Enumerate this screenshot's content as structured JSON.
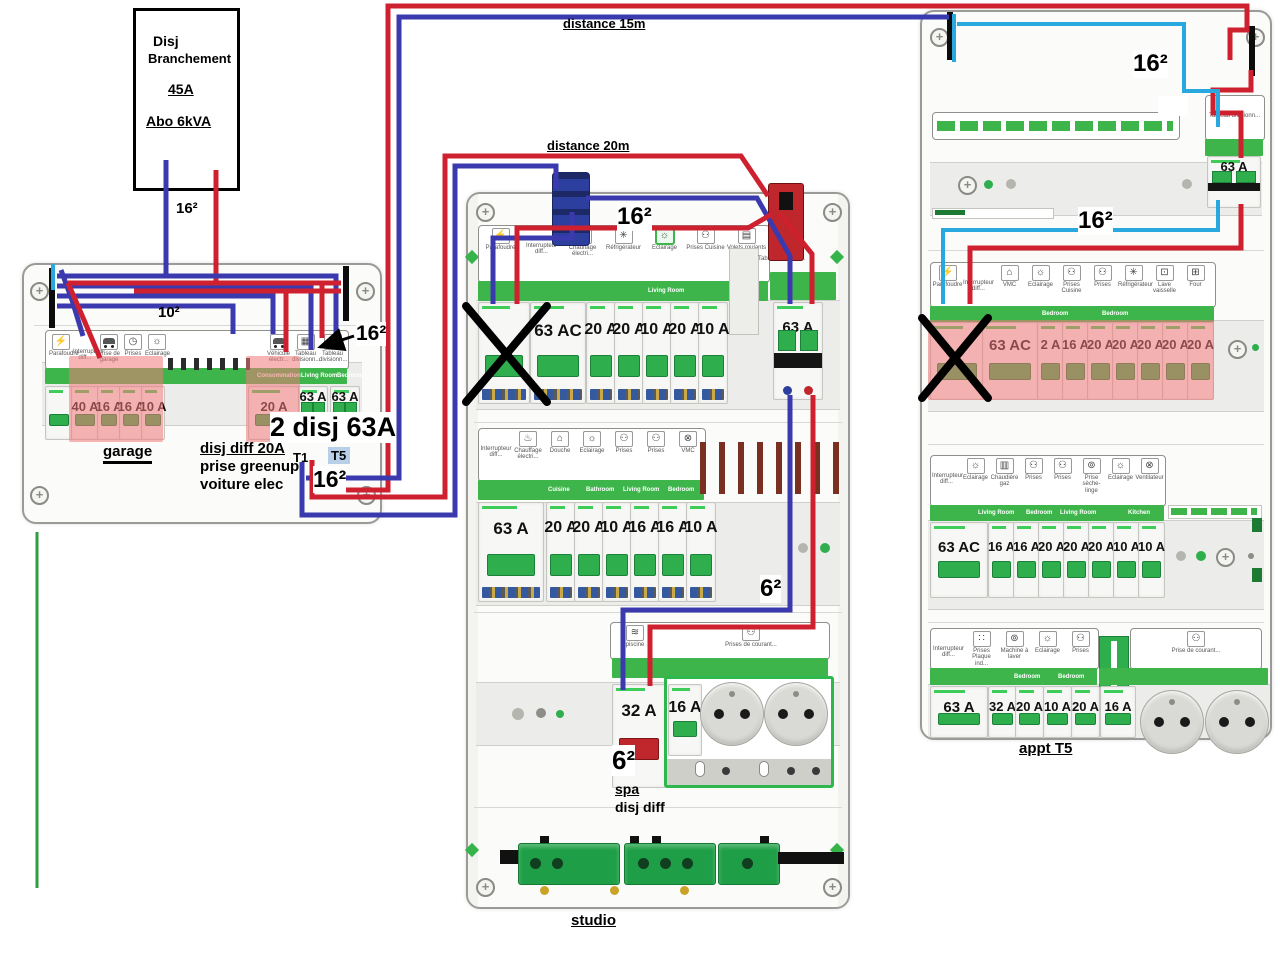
{
  "colors": {
    "phase_red": "#cf2030",
    "neutral_blue": "#3a3aae",
    "link_cyan": "#29a8e0",
    "earth_green": "#2f9e3f",
    "highlight_pink": "rgba(240,120,120,0.55)",
    "band_green": "#3db54a",
    "schneider_green": "#3dcd58"
  },
  "service_box": {
    "title_line1": "Disj",
    "title_line2": "Branchement",
    "rating": "45A",
    "subscription": "Abo 6kVA",
    "wire_size": "16²"
  },
  "links": {
    "distance_15m": "distance 15m",
    "distance_20m": "distance 20m"
  },
  "garage": {
    "name": "garage",
    "wire_size_feed": "10²",
    "wire_size_out": "16²",
    "wire_size_t": "16²",
    "note_2disj": "2 disj 63A",
    "note_line1": "disj diff 20A",
    "note_line2": "prise greenup",
    "note_line3": "voiture elec",
    "t1": "T1",
    "t5": "T5",
    "icons": [
      {
        "icon": "lightning-icon",
        "label": "Parafoudre"
      },
      {
        "icon": "none",
        "label": "Interrupteur diff..."
      },
      {
        "icon": "car-icon",
        "label": "Prise de garage"
      },
      {
        "icon": "clock-icon",
        "label": "Prises"
      },
      {
        "icon": "bulb-icon",
        "label": "Eclairage"
      }
    ],
    "icons_right": [
      {
        "icon": "car-icon",
        "label": "Véhicule électr..."
      },
      {
        "icon": "panel-icon",
        "label": "Tableau divisionn..."
      },
      {
        "icon": "panel-icon",
        "label": "Tableau divisionn..."
      }
    ],
    "zones": [
      "Consommation",
      "Living Room",
      "Bedroom"
    ],
    "breakers": [
      "40 A",
      "16 A",
      "16 A",
      "10 A",
      "20 A",
      "63 A",
      "63 A"
    ]
  },
  "studio": {
    "name": "studio",
    "wire_size_feed": "16²",
    "wire_size_spa": "6²",
    "spa_label": "spa",
    "spa_note": "disj diff",
    "row1": {
      "icons": [
        {
          "icon": "lightning-icon",
          "label": "Parafoudre"
        },
        {
          "icon": "none",
          "label": "Interrupteur diff..."
        },
        {
          "icon": "heater-icon",
          "label": "Chauffage électri..."
        },
        {
          "icon": "snowflake-icon",
          "label": "Réfrigérateur"
        },
        {
          "icon": "bulb-icon",
          "label": "Eclairage",
          "hl": "1"
        },
        {
          "icon": "socket-icon",
          "label": "Prises Cuisine"
        },
        {
          "icon": "shutter-icon",
          "label": "Volets roulants"
        }
      ],
      "zone": "Living Room",
      "breakers": [
        "63 AC",
        "20 A",
        "20 A",
        "10 A",
        "20 A",
        "10 A"
      ],
      "sub_label": "Tableau division...",
      "main": "63 A"
    },
    "row2": {
      "icons": [
        {
          "icon": "none",
          "label": "Interrupteur diff..."
        },
        {
          "icon": "heater-icon",
          "label": "Chauffage électri..."
        },
        {
          "icon": "house-icon",
          "label": "Douche"
        },
        {
          "icon": "bulb-icon",
          "label": "Eclairage"
        },
        {
          "icon": "socket-icon",
          "label": "Prises"
        },
        {
          "icon": "socket-icon",
          "label": "Prises"
        },
        {
          "icon": "fan-icon",
          "label": "VMC"
        }
      ],
      "zones": [
        "Cuisine",
        "Bathroom",
        "Living Room",
        "Bedroom"
      ],
      "breakers": [
        "63 A",
        "20 A",
        "20 A",
        "10 A",
        "16 A",
        "16 A",
        "10 A"
      ]
    },
    "row3": {
      "icons": [
        {
          "icon": "pool-icon",
          "label": "piscine"
        },
        {
          "icon": "socket-icon",
          "label": "Prises de courant..."
        }
      ],
      "breakers": [
        "32 A",
        "16 A"
      ]
    }
  },
  "appt": {
    "name": "appt T5",
    "wire_size_top": "16²",
    "wire_size_mid": "16²",
    "row1": {
      "sub_label": "Tableau divisionn...",
      "main": "63 A"
    },
    "row2": {
      "icons": [
        {
          "icon": "lightning-icon",
          "label": "Parafoudre"
        },
        {
          "icon": "none",
          "label": "Interrupteur diff..."
        },
        {
          "icon": "house-icon",
          "label": "VMC"
        },
        {
          "icon": "bulb-icon",
          "label": "Eclairage"
        },
        {
          "icon": "socket-icon",
          "label": "Prises Cuisine"
        },
        {
          "icon": "socket-icon",
          "label": "Prises"
        },
        {
          "icon": "snowflake-icon",
          "label": "Réfrigérateur"
        },
        {
          "icon": "dishwasher-icon",
          "label": "Lave vaisselle"
        },
        {
          "icon": "oven-icon",
          "label": "Four"
        }
      ],
      "zones": [
        "Bedroom",
        "Bedroom"
      ],
      "breakers": [
        "63 AC",
        "2 A",
        "16 A",
        "20 A",
        "20 A",
        "20 A",
        "20 A",
        "20 A"
      ]
    },
    "row3": {
      "icons": [
        {
          "icon": "none",
          "label": "Interrupteur diff..."
        },
        {
          "icon": "bulb-icon",
          "label": "Eclairage"
        },
        {
          "icon": "boiler-icon",
          "label": "Chaudière gaz"
        },
        {
          "icon": "socket-icon",
          "label": "Prises"
        },
        {
          "icon": "socket-icon",
          "label": "Prises"
        },
        {
          "icon": "washer-icon",
          "label": "Prise sèche-linge"
        },
        {
          "icon": "bulb-icon",
          "label": "Eclairage"
        },
        {
          "icon": "fan-icon",
          "label": "Ventilateur"
        }
      ],
      "zones": [
        "Living Room",
        "Bedroom",
        "Living Room",
        "Kitchen"
      ],
      "breakers": [
        "63 AC",
        "16 A",
        "16 A",
        "20 A",
        "20 A",
        "20 A",
        "10 A",
        "10 A"
      ]
    },
    "row4": {
      "icons": [
        {
          "icon": "none",
          "label": "Interrupteur diff..."
        },
        {
          "icon": "induction-icon",
          "label": "Prises Plaque ind..."
        },
        {
          "icon": "washer-icon",
          "label": "Machine à laver"
        },
        {
          "icon": "bulb-icon",
          "label": "Eclairage"
        },
        {
          "icon": "socket-icon",
          "label": "Prises"
        }
      ],
      "socket_label": "Prise de courant...",
      "zones": [
        "Bedroom",
        "Bedroom"
      ],
      "breakers": [
        "63 A",
        "32 A",
        "20 A",
        "10 A",
        "20 A",
        "16 A"
      ]
    }
  }
}
